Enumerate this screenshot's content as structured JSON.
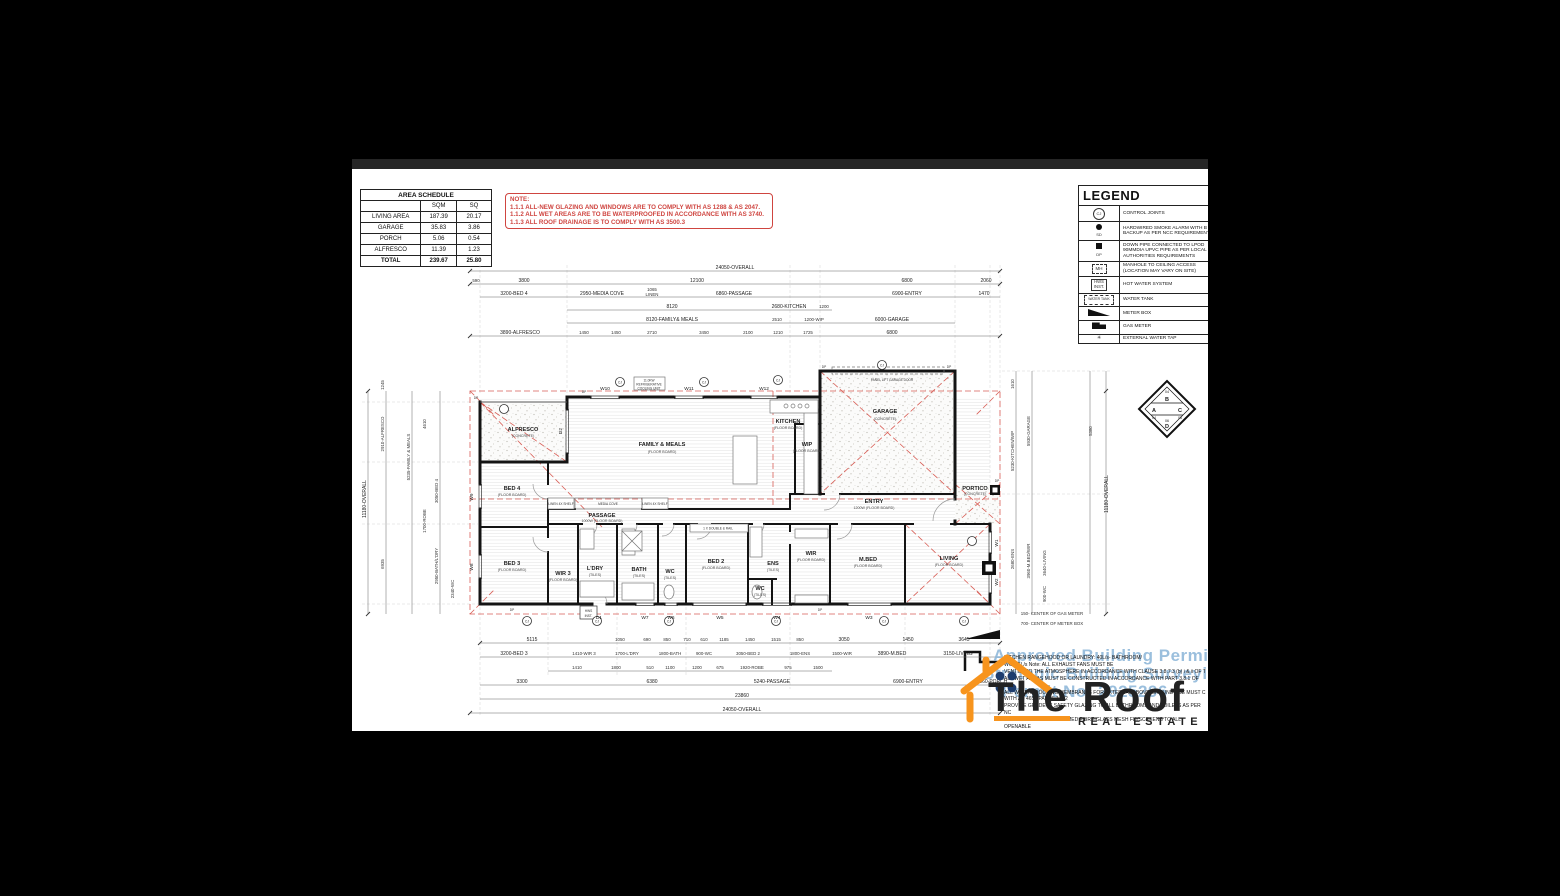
{
  "area_schedule": {
    "title": "AREA SCHEDULE",
    "headers": [
      "SQM",
      "SQ"
    ],
    "rows": [
      [
        "LIVING AREA",
        "187.39",
        "20.17"
      ],
      [
        "GARAGE",
        "35.83",
        "3.86"
      ],
      [
        "PORCH",
        "5.06",
        "0.54"
      ],
      [
        "ALFRESCO",
        "11.39",
        "1.23"
      ]
    ],
    "total": [
      "TOTAL",
      "239.67",
      "25.80"
    ]
  },
  "note_box": {
    "title": "NOTE:",
    "lines": [
      "1.1.1 ALL-NEW GLAZING AND WINDOWS ARE TO COMPLY WITH AS 1288 & AS 2047.",
      "1.1.2 ALL WET AREAS ARE TO BE WATERPROOFED IN ACCORDANCE WITH AS 3740.",
      "1.1.3 ALL ROOF DRAINAGE IS TO COMPLY WITH AS 3500.3"
    ]
  },
  "legend": {
    "title": "LEGEND",
    "items": [
      {
        "sym": "CJ",
        "label": "CONTROL JOINTS"
      },
      {
        "sym": "SD",
        "label": "HARDWIRED SMOKE ALARM WITH B\nBACKUP AS PER NCC REQUIREMENT"
      },
      {
        "sym": "DP",
        "label": "DOWN PIPE CONNECTED TO LPOD\n90MMDIA UPVC PIPE AS PER LOCAL\nAUTHORITIES REQUIREMENTS"
      },
      {
        "sym": "MH",
        "label": "MANHOLE TO CEILING ACCESS\n(LOCATION MAY VARY ON SITE)"
      },
      {
        "sym": "HWS\nINST.",
        "label": "HOT WATER SYSTEM"
      },
      {
        "sym": "WATER TANK",
        "label": "WATER TANK"
      },
      {
        "sym": "",
        "label": "METER BOX"
      },
      {
        "sym": "",
        "label": "GAS METER"
      },
      {
        "sym": "✳",
        "label": "EXTERNAL WATER TAP"
      }
    ]
  },
  "rooms": [
    {
      "name": "ALFRESCO",
      "sub": "(CONCRETE)"
    },
    {
      "name": "FAMILY & MEALS",
      "sub": "(FLOOR BOARD)"
    },
    {
      "name": "KITCHEN",
      "sub": "(FLOOR BOARD)"
    },
    {
      "name": "WIP",
      "sub": "(FLOOR BOARD)"
    },
    {
      "name": "GARAGE",
      "sub": "(CONCRETE)"
    },
    {
      "name": "ENTRY",
      "sub": "1200W (FLOOR BOARD)"
    },
    {
      "name": "PORTICO",
      "sub": "(CONCRETE)"
    },
    {
      "name": "PASSAGE",
      "sub": "1000W (FLOOR BOARD)"
    },
    {
      "name": "BED 4",
      "sub": "(FLOOR BOARD)"
    },
    {
      "name": "BED 3",
      "sub": "(FLOOR BOARD)"
    },
    {
      "name": "WIR 3",
      "sub": "(FLOOR BOARD)"
    },
    {
      "name": "L'DRY",
      "sub": "(TILES)"
    },
    {
      "name": "BATH",
      "sub": "(TILES)"
    },
    {
      "name": "WC",
      "sub": "(TILES)"
    },
    {
      "name": "BED 2",
      "sub": "(FLOOR BOARD)"
    },
    {
      "name": "ENS",
      "sub": "(TILES)"
    },
    {
      "name": "WC",
      "sub": "(TILES)"
    },
    {
      "name": "WIR",
      "sub": "(FLOOR BOARD)"
    },
    {
      "name": "M.BED",
      "sub": "(FLOOR BOARD)"
    },
    {
      "name": "LIVING",
      "sub": "(FLOOR BOARD)"
    }
  ],
  "openings": {
    "top": [
      "W10",
      "W11",
      "W12"
    ],
    "bottom": [
      "D1",
      "W7",
      "W6",
      "W5",
      "W4",
      "W3"
    ],
    "left": [
      "W9",
      "W8"
    ],
    "right": [
      "W1",
      "W2"
    ],
    "alfresco_door": "D2"
  },
  "dims": {
    "t1": "24050-OVERALL",
    "t2": [
      "590",
      "3800",
      "12100",
      "6800",
      "2060"
    ],
    "t3": [
      "3200-BED 4",
      "2950-MEDIA COVE",
      "1065",
      "LINEN",
      "6860-PASSAGE",
      "6900-ENTRY",
      "1470"
    ],
    "t4": [
      "8120",
      "2680-KITCHEN",
      "1200"
    ],
    "t5": [
      "8120-FAMILY& MEALS",
      "2510",
      "1200-WIP",
      "6000-GARAGE"
    ],
    "t6": [
      "3890-ALFRESCO",
      "1450",
      "1450",
      "2710",
      "3450",
      "2100",
      "1210",
      "1725",
      "6800"
    ],
    "b1": [
      "5115",
      "1050",
      "690",
      "850",
      "710",
      "610",
      "1185",
      "1450",
      "1515",
      "850",
      "3050",
      "1450",
      "3645"
    ],
    "b2": [
      "3200-BED 3",
      "1410-WIR 3",
      "1700-L'DRY",
      "1800-BATH",
      "900-WC",
      "3050-BED 2",
      "1800-ENS",
      "1500-WIR",
      "3890-M.BED",
      "3150-LIVING"
    ],
    "b3": [
      "1410",
      "1800",
      "510",
      "1100",
      "1200",
      "675",
      "1920-ROBE",
      "975",
      "1500"
    ],
    "b4": [
      "3300",
      "6380",
      "5240-PASSAGE",
      "6900-ENTRY",
      "2060-PORCH"
    ],
    "b5": "23860",
    "b6": "24050-OVERALL",
    "l1": "11180-OVERALL",
    "l2": [
      "1245",
      "2910-ALFRESCO",
      "6935"
    ],
    "l3": [
      "5235-FAMILY & MEALS",
      "4610",
      "3050-BED 4",
      "2950-BATH/L'DRY",
      "2340-WC",
      "1700-ROBE"
    ],
    "r1": "11180-OVERALL",
    "r2": [
      "1610",
      "5930-GARAGE",
      "5380"
    ],
    "r3": [
      "5230-KITCHEN/WIP",
      "3960-M.BED/WIR",
      "3640-LIVING",
      "2680-ENS",
      "900-WC"
    ]
  },
  "annotations": {
    "cooling": [
      "11.0KW",
      "REFRIGERATIVE",
      "COOLING UNIT"
    ],
    "panel_door": "PANEL LIFT GARAGE DOOR",
    "media": "MEDIA COVE",
    "linen": "LINEN 4X SHELF",
    "robe": "1 X DOUBLE & RAIL",
    "hws1": "HWS",
    "hws2": "INST.",
    "gas": "150- CENTER OF GAS METER",
    "meter": "700- CENTER OF METER BOX",
    "dp": "DP",
    "cj": "CJ"
  },
  "compass": {
    "t": "B",
    "l": "A",
    "r": "C",
    "b": "D",
    "n_top": "04",
    "n_l": "04",
    "n_r": "05",
    "n_b": "06"
  },
  "watermark": {
    "lines": [
      "Approved Building Permit",
      "Strategic Building Surveying",
      "Permit No: 2925296"
    ]
  },
  "logo": {
    "name": "The Roof",
    "tag": "REAL ESTATE"
  },
  "notes": {
    "lines": [
      "KITCHEN RANGEHOOD OR LAUNDRY: 40L/s- BATHROOM/",
      "WC: 25L/s Note: ALL EXHAUST FANS MUST BE",
      "VENTED TO THE ATMOSPHERE IN ACCORDANCE WITH CLAUSE 3.8.7.3 (b) i & ii OF T",
      "ALL WET AREAS MUST BE CONSTRUCTED IN ACCORDANCE WITH PART 3.8.1 OF TH",
      "ALL WATERPROOFING MEMBRANES FOR EXTERNAL ABOVE GROUND USE MUST C",
      "WITH AS 4654 PARTS 1 & 2",
      "PROVIDE GRADE 'A' SAFETY GLAZING TO ALL BATHROOMS AND TOILETS AS PER NC",
      "PROVIDE ALUMINIUM FRAMED FIBRE-GLASS MESH FLYSCREENS TO ALL OPENABLE",
      "WINDOWS.",
      "ALL INTERNAL DOORS TO BE 2340MM HIGH, INCLUDING ALL ROBES AND LINENS."
    ]
  }
}
